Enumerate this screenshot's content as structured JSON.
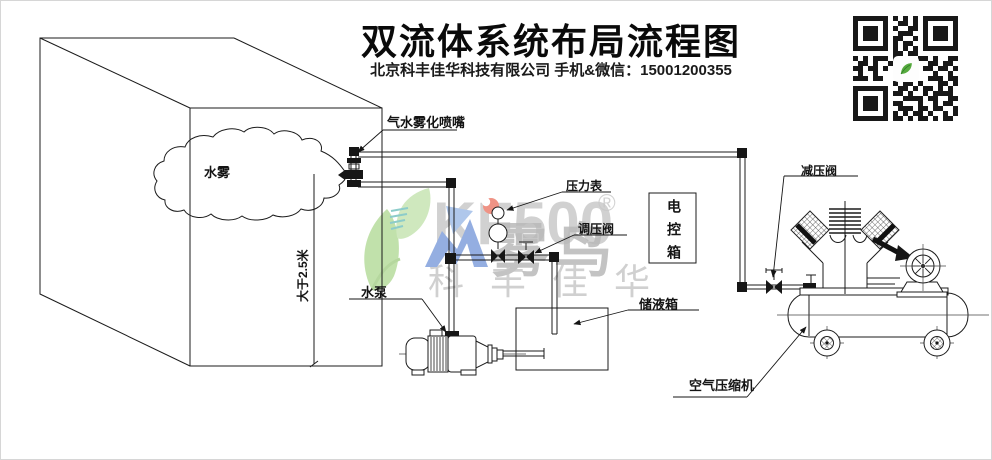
{
  "header": {
    "title": "双流体系统布局流程图",
    "subtitle": "北京科丰佳华科技有限公司 手机&微信：15001200355"
  },
  "labels": {
    "nozzle": "气水雾化喷嘴",
    "mist": "水雾",
    "height_dim": "大于2.5米",
    "pressure_gauge": "压力表",
    "regulating_valve": "调压阀",
    "control_box": "电控箱",
    "water_pump": "水泵",
    "liquid_tank": "储液箱",
    "reducing_valve": "减压阀",
    "air_compressor": "空气压缩机"
  },
  "watermark": {
    "latin": "KF500",
    "reg": "®",
    "brand": "雾鸟",
    "company": "科丰佳华",
    "colors": {
      "leaf": "#8fc866",
      "teal": "#2fa3a0",
      "blue": "#3d6dc9",
      "blue_light": "#6f9bdb",
      "red": "#e33b22",
      "gray": "#8f8f8f"
    }
  },
  "qr": {
    "center_icon": "green-bird-leaf-logo",
    "rows": [
      "111111101010101111111",
      "100000100110101000001",
      "101110101001101011101",
      "101110100111001011101",
      "101110101100101011101",
      "100000101011001000001",
      "111111101010101111111",
      "000000001101100000000",
      "101011101001011010011",
      "011010010110100110110",
      "110110100000001101101",
      "010010000000000010010",
      "111011000000000111011",
      "000000001011010001101",
      "111111100110101101010",
      "100000101101001011110",
      "101110100011110110011",
      "101110101100010010110",
      "101110100111011011001",
      "100000101010110100101",
      "111111101101011010110"
    ]
  }
}
